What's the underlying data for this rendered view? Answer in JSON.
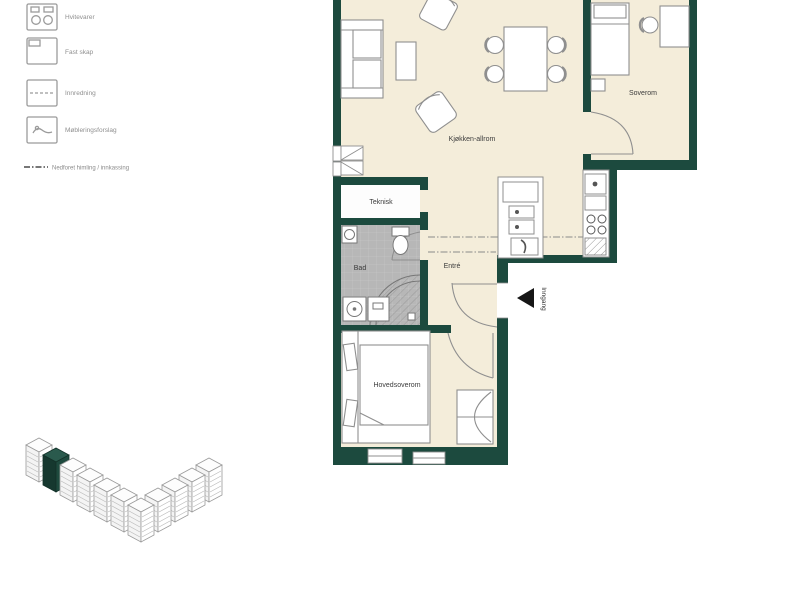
{
  "legend": {
    "items": [
      {
        "icon": "appliances-icon",
        "label": "Hvitevarer"
      },
      {
        "icon": "fixed-cabinet-icon",
        "label": "Fast skap"
      },
      {
        "icon": "fittings-icon",
        "label": "Innredning"
      },
      {
        "icon": "furnishing-icon",
        "label": "Møbleringsforslag"
      }
    ],
    "note": {
      "symbol": "dash-dot-line",
      "label": "Nedforet himling / innkassing"
    }
  },
  "floor_plan": {
    "rooms": [
      {
        "name": "kitchen-living",
        "label": "Kjøkken-allrom"
      },
      {
        "name": "bedroom-2",
        "label": "Soverom"
      },
      {
        "name": "technical-room",
        "label": "Teknisk"
      },
      {
        "name": "bathroom",
        "label": "Bad"
      },
      {
        "name": "hallway",
        "label": "Entré"
      },
      {
        "name": "master-bedroom",
        "label": "Hovedsoverom"
      }
    ],
    "entrance_label": "Inngang"
  },
  "colors": {
    "wall": "#1c4a3e",
    "floor": "#f4edda",
    "bath_tile": "#b7b7b7",
    "outline": "#8f8f8f",
    "highlight_unit": "#1e4a3e"
  }
}
